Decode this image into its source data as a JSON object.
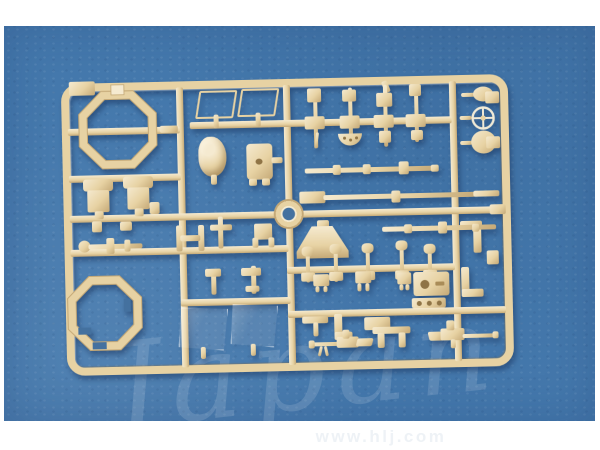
{
  "watermarks": {
    "script": "Japan",
    "url": "www.hlj.com"
  },
  "colors": {
    "blue": "#4478ac",
    "blue_flat": "#44719f",
    "tan": "#e7d2a3",
    "tan_hi": "#f5ead0",
    "tan_lo": "#c4a876",
    "hole": "#8f7446",
    "border_white": "#ffffff",
    "url_text": "#eef2f6"
  }
}
